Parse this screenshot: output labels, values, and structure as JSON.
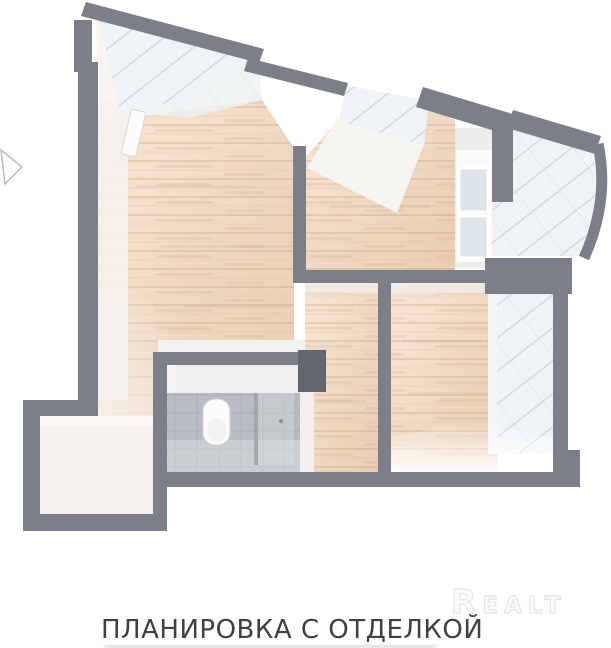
{
  "image": {
    "kind": "apartment floor plan 3d render",
    "caption": {
      "text": "ПЛАНИРОВКА С ОТДЕЛКОЙ"
    },
    "watermark": {
      "text": "Realt"
    }
  },
  "icons": {
    "toilet": "toilet-icon",
    "cursor_arrow": "cursor-arrow-icon"
  },
  "palette": {
    "bg": "#ffffff",
    "wall": "#7c7f88",
    "wall-dark": "#63666f",
    "wall-light": "#8d909a",
    "wood": "#efd6bf",
    "wood-streak": "#c99f7f",
    "glass": "#eff3f6",
    "glass-line": "#c3cdd6",
    "inner-face": "#f7f4f1",
    "hall-floor": "#f5f0ec",
    "bath-floor": "#b9bdc3",
    "bath-wall": "#ebebea",
    "fixture": "#fcfcfc",
    "caption-color": "#404043",
    "watermark-color": "#fbfbfb",
    "watermark-stroke": "#e6e6e6",
    "arrow-color": "#bdbdbd"
  }
}
